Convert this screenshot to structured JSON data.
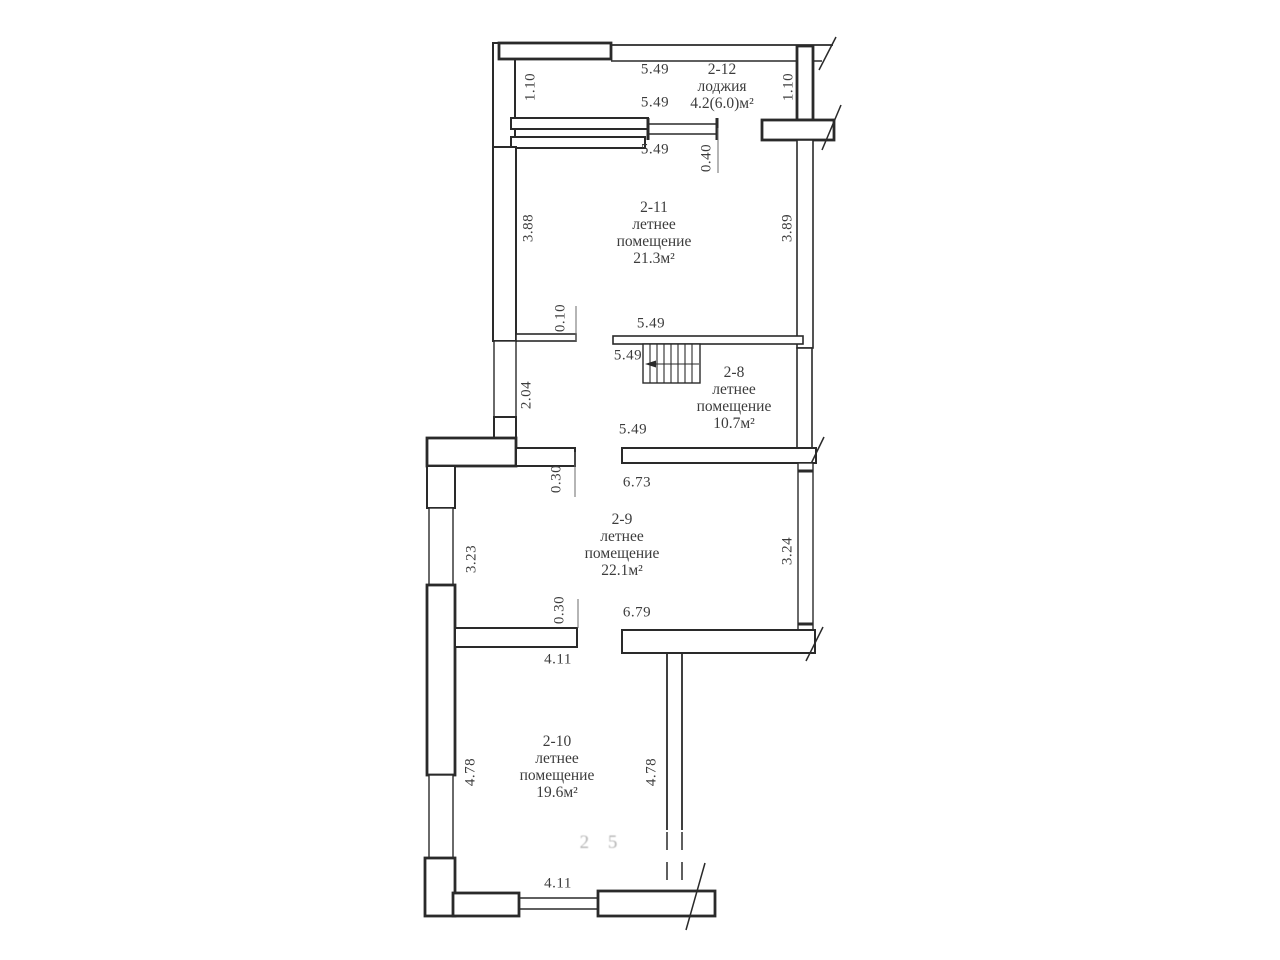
{
  "page": {
    "background_color": "#ffffff",
    "line_color": "#2a2a2a",
    "text_color": "#3c3c3c",
    "watermark_color": "#b5b5b5"
  },
  "rooms": [
    {
      "id": "2-12",
      "lines": [
        "2-12",
        "лоджия",
        "4.2(6.0)м²"
      ],
      "cx": 722,
      "top": 61
    },
    {
      "id": "2-11",
      "lines": [
        "2-11",
        "летнее",
        "помещение",
        "21.3м²"
      ],
      "cx": 654,
      "top": 199
    },
    {
      "id": "2-8",
      "lines": [
        "2-8",
        "летнее",
        "помещение",
        "10.7м²"
      ],
      "cx": 734,
      "top": 364
    },
    {
      "id": "2-9",
      "lines": [
        "2-9",
        "летнее",
        "помещение",
        "22.1м²"
      ],
      "cx": 622,
      "top": 511
    },
    {
      "id": "2-10",
      "lines": [
        "2-10",
        "летнее",
        "помещение",
        "19.6м²"
      ],
      "cx": 557,
      "top": 733
    }
  ],
  "dimensions": [
    {
      "text": "5.49",
      "x": 655,
      "y": 70,
      "rot": 0
    },
    {
      "text": "1.10",
      "x": 531,
      "y": 87,
      "rot": -90
    },
    {
      "text": "1.10",
      "x": 789,
      "y": 87,
      "rot": -90
    },
    {
      "text": "5.49",
      "x": 655,
      "y": 103,
      "rot": 0
    },
    {
      "text": "5.49",
      "x": 655,
      "y": 150,
      "rot": 0
    },
    {
      "text": "0.40",
      "x": 707,
      "y": 158,
      "rot": -90
    },
    {
      "text": "3.88",
      "x": 529,
      "y": 228,
      "rot": -90
    },
    {
      "text": "3.89",
      "x": 788,
      "y": 228,
      "rot": -90
    },
    {
      "text": "0.10",
      "x": 561,
      "y": 318,
      "rot": -90
    },
    {
      "text": "5.49",
      "x": 651,
      "y": 324,
      "rot": 0
    },
    {
      "text": "5.49",
      "x": 628,
      "y": 356,
      "rot": 0
    },
    {
      "text": "2.04",
      "x": 527,
      "y": 395,
      "rot": -90
    },
    {
      "text": "5.49",
      "x": 633,
      "y": 430,
      "rot": 0
    },
    {
      "text": "0.30",
      "x": 557,
      "y": 479,
      "rot": -90
    },
    {
      "text": "6.73",
      "x": 637,
      "y": 483,
      "rot": 0
    },
    {
      "text": "3.23",
      "x": 472,
      "y": 559,
      "rot": -90
    },
    {
      "text": "3.24",
      "x": 788,
      "y": 551,
      "rot": -90
    },
    {
      "text": "0.30",
      "x": 560,
      "y": 610,
      "rot": -90
    },
    {
      "text": "6.79",
      "x": 637,
      "y": 613,
      "rot": 0
    },
    {
      "text": "4.11",
      "x": 558,
      "y": 660,
      "rot": 0
    },
    {
      "text": "4.78",
      "x": 471,
      "y": 772,
      "rot": -90
    },
    {
      "text": "4.78",
      "x": 652,
      "y": 772,
      "rot": -90
    },
    {
      "text": "4.11",
      "x": 558,
      "y": 884,
      "rot": 0
    }
  ],
  "watermark": {
    "text": "2 5",
    "x": 602,
    "y": 843
  }
}
